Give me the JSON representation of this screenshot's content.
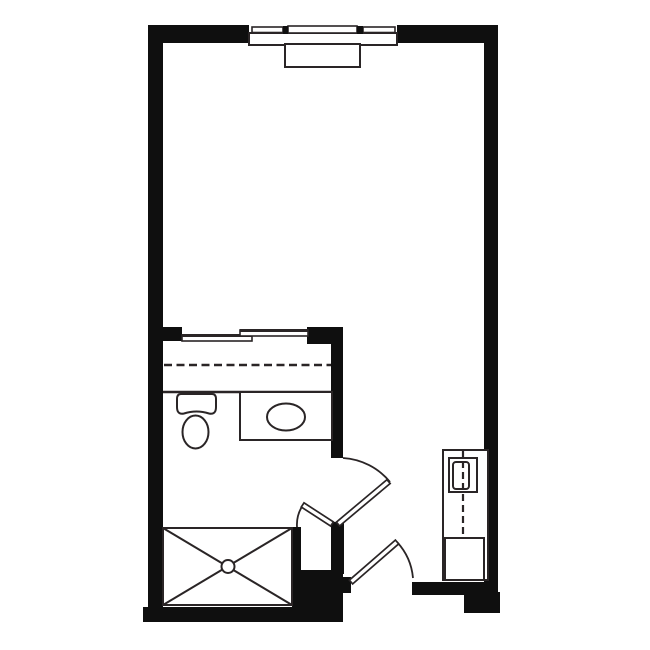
{
  "document": {
    "kind": "architectural-floor-plan",
    "style": "black-and-white line drawing, studio suite with bathroom, entry and closets",
    "visible_text": []
  },
  "colors": {
    "wall": "#0f0f0f",
    "line": "#2a2526",
    "background": "#ffffff"
  },
  "fixtures": {
    "window": "triple-pane-window-symbol",
    "window_sill": "sill-band",
    "hvac_unit": "under-window-protruding-unit",
    "bypass_doors": "sliding-bypass-closet-doors",
    "closet_rod": "dashed-hanging-rod",
    "closet_back": "closet-back-partition-line",
    "toilet": "toilet-symbol-tank-and-bowl",
    "vanity": "vanity-counter-with-oval-sink",
    "shower": "shower-pan-with-x-and-center-drain",
    "bathroom_door": "hinged-swing-door-with-arc",
    "niche_door": "small-hinged-door-with-arc",
    "entry_door": "hinged-entry-swing-door-with-arc",
    "wardrobe": "tall-closet-with-dashed-rod",
    "wardrobe_appliance": "upper-unit-box-symbol",
    "wardrobe_shelf": "lower-shelf-box-symbol"
  }
}
